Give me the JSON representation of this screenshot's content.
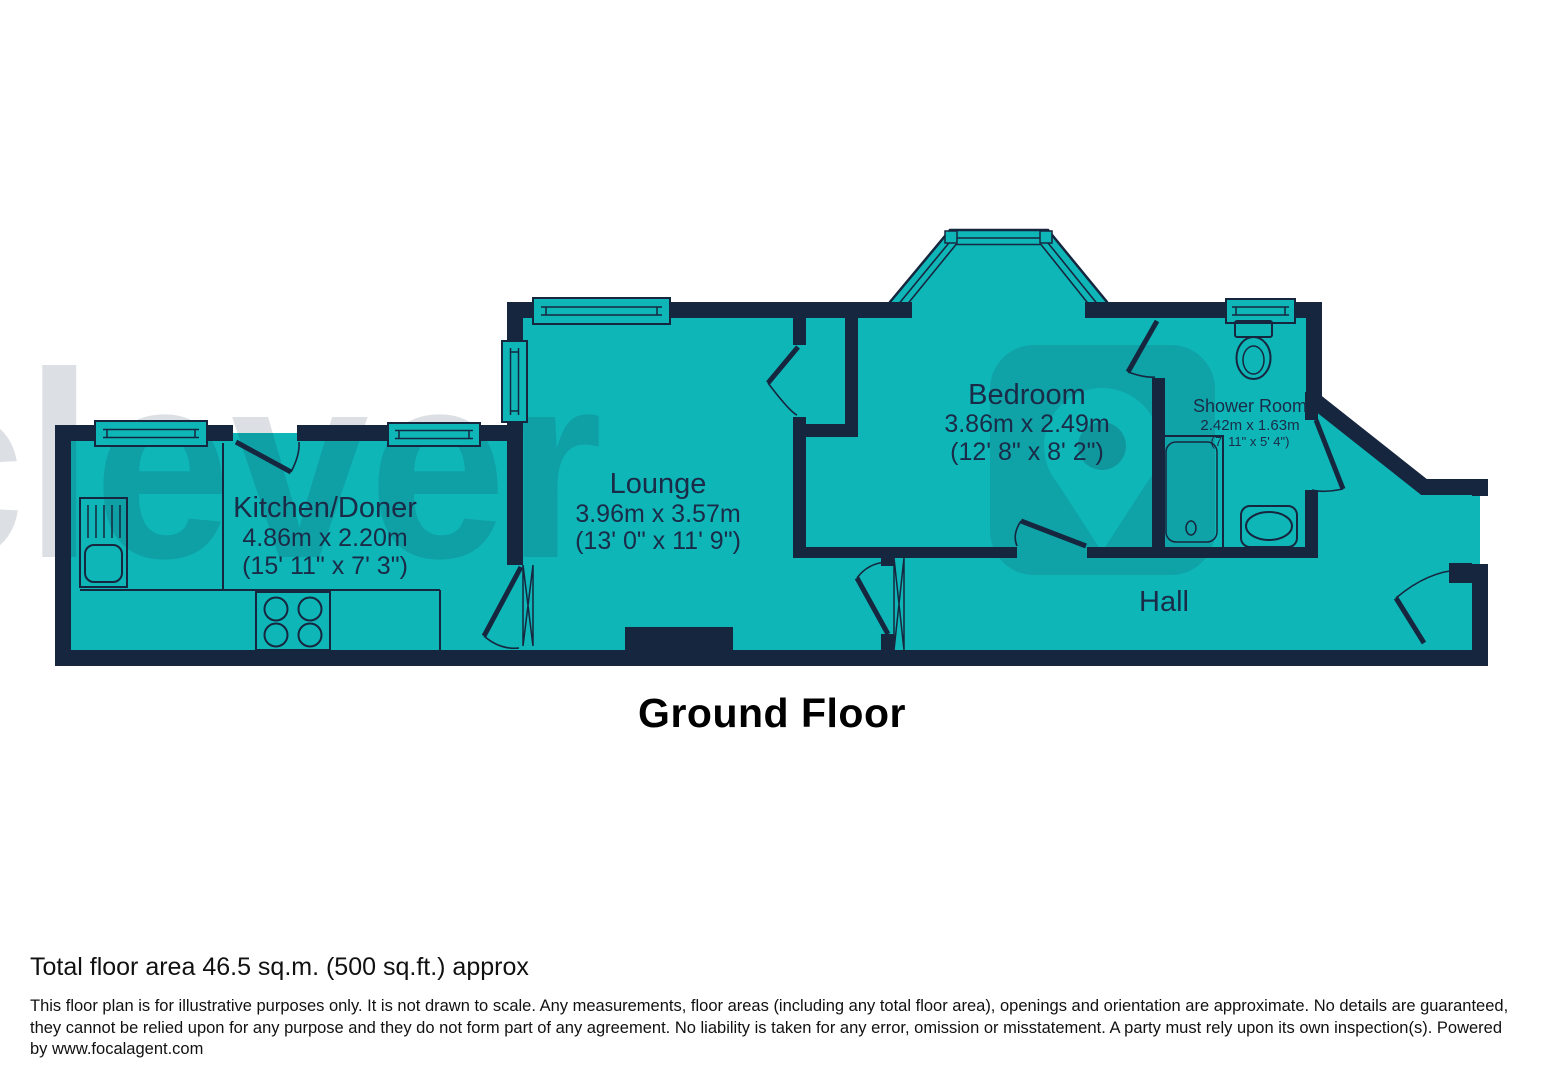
{
  "floorplan": {
    "title": "Ground Floor",
    "total_area": "Total floor area 46.5 sq.m. (500 sq.ft.) approx",
    "disclaimer": "This floor plan is for illustrative purposes only. It is not drawn to scale. Any measurements, floor areas (including any total floor area), openings and orientation are approximate. No details are guaranteed, they cannot be relied upon for any purpose and they do not form part of any agreement. No liability is taken for any error, omission or misstatement. A party must rely upon its own inspection(s). Powered by www.focalagent.com",
    "watermark": {
      "text": "clever"
    },
    "colors": {
      "wall": "#16263E",
      "floor": "#0FB6B8",
      "label": "#1A2B47"
    },
    "rooms": [
      {
        "name": "Kitchen/Doner",
        "metric": "4.86m x 2.20m",
        "imperial": "(15' 11\" x 7' 3\")"
      },
      {
        "name": "Lounge",
        "metric": "3.96m x 3.57m",
        "imperial": "(13' 0\" x 11' 9\")"
      },
      {
        "name": "Bedroom",
        "metric": "3.86m x 2.49m",
        "imperial": "(12' 8\" x 8' 2\")"
      },
      {
        "name": "Shower Room",
        "metric": "2.42m x 1.63m",
        "imperial": "(7' 11\" x 5' 4\")"
      },
      {
        "name": "Hall"
      }
    ]
  }
}
